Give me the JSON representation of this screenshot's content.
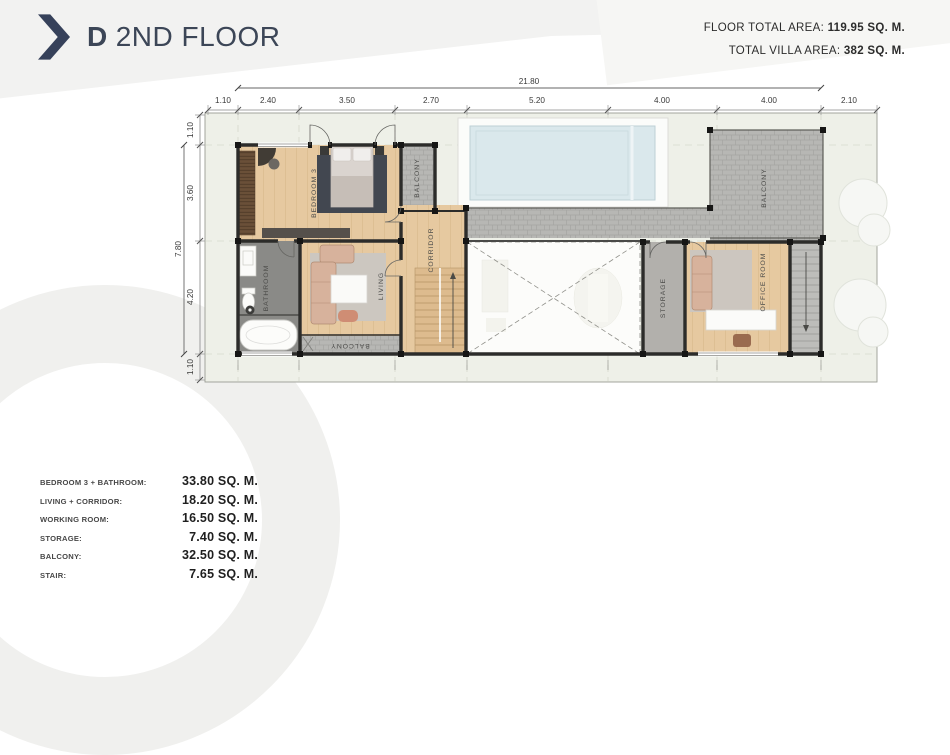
{
  "header": {
    "marker": "D",
    "title": "2ND FLOOR"
  },
  "stats": {
    "floor_label": "FLOOR TOTAL AREA: ",
    "floor_value": "119.95 SQ. M.",
    "villa_label": "TOTAL VILLA AREA: ",
    "villa_value": "382 SQ. M."
  },
  "legend": [
    {
      "label": "BEDROOM 3 + BATHROOM:",
      "value": "33.80 SQ. M."
    },
    {
      "label": "LIVING + CORRIDOR:",
      "value": "18.20 SQ. M."
    },
    {
      "label": "WORKING ROOM:",
      "value": "16.50 SQ. M."
    },
    {
      "label": "STORAGE:",
      "value": "7.40 SQ. M."
    },
    {
      "label": "BALCONY:",
      "value": "32.50 SQ. M."
    },
    {
      "label": "STAIR:",
      "value": "7.65 SQ. M."
    }
  ],
  "dims": {
    "top_total": "21.80",
    "top": [
      "1.10",
      "2.40",
      "3.50",
      "2.70",
      "5.20",
      "4.00",
      "4.00",
      "2.10"
    ],
    "left_total": "7.80",
    "left": [
      "1.10",
      "3.60",
      "4.20",
      "1.10"
    ]
  },
  "rooms": {
    "bedroom": "BEDROOM 3",
    "balcony_small": "BALCONY",
    "corridor": "CORRIDOR",
    "bathroom": "BATHROOM",
    "living": "LIVING",
    "balcony_living": "BALCONY",
    "storage": "STORAGE",
    "office": "OFFICE ROOM",
    "balcony_main": "BALCONY"
  },
  "colors": {
    "accent": "#36415a",
    "field": "#eef0e8",
    "wood": "#e6c9a0",
    "tile": "#b7b7b4",
    "pool": "#dae8ec",
    "wall": "#2c2c2a"
  }
}
